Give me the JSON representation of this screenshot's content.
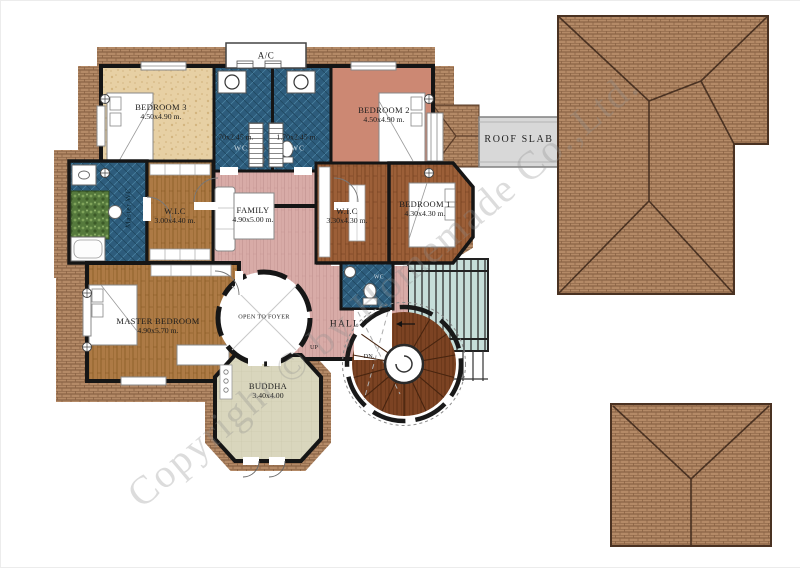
{
  "watermark": {
    "text": "Copyright © by Homemade Co.,Ltd."
  },
  "labels": {
    "ac": "A/C",
    "roof_slab": "ROOF SLAB",
    "wc_left": "WC",
    "wc_right": "WC",
    "wc_hall": "WC",
    "wc_dim_left": "1.70x2.45 m.",
    "wc_dim_right": "1.70x2.45 m.",
    "master_wc": "Master WC",
    "open_to_foyer": "OPEN TO FOYER",
    "hall": "HALL",
    "up": "UP",
    "dn": "DN."
  },
  "rooms": {
    "bedroom3": {
      "name": "BEDROOM 3",
      "dim": "4.50x4.90 m."
    },
    "bedroom2": {
      "name": "BEDROOM 2",
      "dim": "4.50x4.90 m."
    },
    "bedroom1": {
      "name": "BEDROOM 1",
      "dim": "4.30x4.30 m."
    },
    "master_bedroom": {
      "name": "MASTER BEDROOM",
      "dim": "4.90x5.70 m."
    },
    "wic_left": {
      "name": "W.I.C",
      "dim": "3.00x4.40 m."
    },
    "wic_right": {
      "name": "W.I.C",
      "dim": "3.30x4.30 m."
    },
    "family": {
      "name": "FAMILY",
      "dim": "4.90x5.00 m."
    },
    "buddha": {
      "name": "BUDDHA",
      "dim": "3.40x4.00"
    }
  },
  "palette": {
    "roof_tile": "#b48a67",
    "roof_line": "#6e4a30",
    "wc_tile": "#2d5c7c",
    "family_floor": "#d8aba7",
    "wood_floor": "#ad7a45",
    "dark_wood_floor": "#9c5f38",
    "stone_floor": "#e7d0a4",
    "bedroom2_floor": "#cc8873",
    "buddha_floor": "#d9d6bd",
    "skylight": "#c6ded9",
    "roof_slab": "#d8d8d8",
    "stair_wood": "#7c4323",
    "wall": "#151515"
  }
}
